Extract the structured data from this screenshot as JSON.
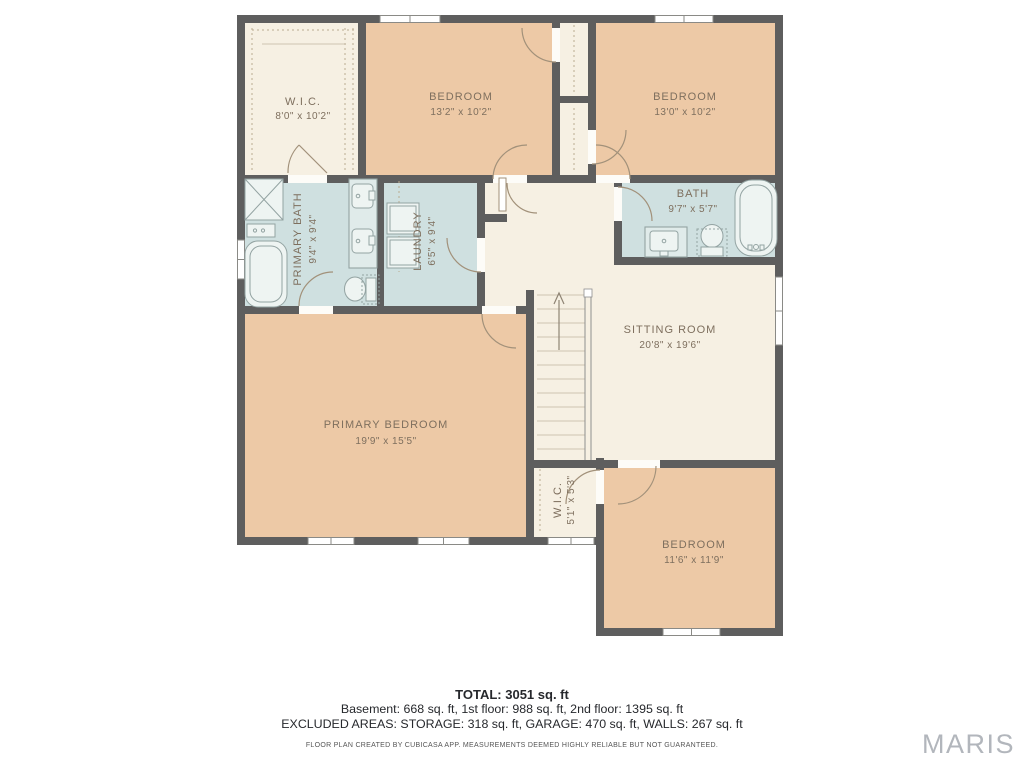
{
  "page": {
    "background_color": "#ffffff",
    "watermark": "MARIS"
  },
  "floor_plan": {
    "colors": {
      "wall": "#5e5e5e",
      "bedroom_fill": "#edc9a6",
      "floor_fill": "#f6f0e3",
      "wet_room_fill": "#cfe0e0",
      "label_text": "#7e6f5e"
    },
    "rooms": [
      {
        "id": "wic-upper",
        "name": "W.I.C.",
        "dims": "8'0\" x 10'2\""
      },
      {
        "id": "bedroom-top-middle",
        "name": "BEDROOM",
        "dims": "13'2\" x 10'2\""
      },
      {
        "id": "bedroom-top-right",
        "name": "BEDROOM",
        "dims": "13'0\" x 10'2\""
      },
      {
        "id": "primary-bath",
        "name": "PRIMARY BATH",
        "dims": "9'4\" x 9'4\""
      },
      {
        "id": "laundry",
        "name": "LAUNDRY",
        "dims": "6'5\" x 9'4\""
      },
      {
        "id": "bath",
        "name": "BATH",
        "dims": "9'7\" x 5'7\""
      },
      {
        "id": "sitting-room",
        "name": "SITTING ROOM",
        "dims": "20'8\" x 19'6\""
      },
      {
        "id": "primary-bedroom",
        "name": "PRIMARY BEDROOM",
        "dims": "19'9\" x 15'5\""
      },
      {
        "id": "wic-lower",
        "name": "W.I.C.",
        "dims": "5'1\" x 5'3\""
      },
      {
        "id": "bedroom-bottom-right",
        "name": "BEDROOM",
        "dims": "11'6\" x 11'9\""
      }
    ]
  },
  "summary": {
    "total": "TOTAL: 3051 sq. ft",
    "floors": "Basement: 668 sq. ft, 1st floor: 988 sq. ft, 2nd floor: 1395 sq. ft",
    "excluded": "EXCLUDED AREAS: STORAGE: 318 sq. ft, GARAGE: 470 sq. ft, WALLS: 267 sq. ft"
  },
  "disclaimer": "FLOOR PLAN CREATED BY CUBICASA APP. MEASUREMENTS DEEMED HIGHLY RELIABLE BUT NOT GUARANTEED."
}
